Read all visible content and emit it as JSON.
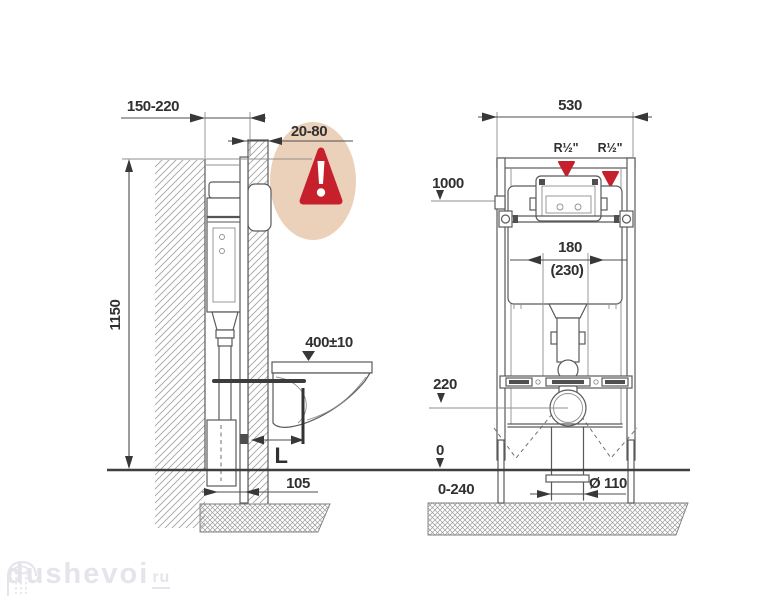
{
  "side_view": {
    "wall_depth": "150-220",
    "cladding_thickness": "20-80",
    "frame_height": "1150",
    "seat_height": "400±10",
    "offset_label": "L",
    "frame_depth": "105"
  },
  "front_view": {
    "frame_width": "530",
    "water_conn_left": "R½\"",
    "water_conn_right": "R½\"",
    "install_height": "1000",
    "flush_pipe_offset": "180",
    "flush_pipe_offset_alt": "(230)",
    "outlet_height": "220",
    "floor_level": "0",
    "below_floor_range": "0-240",
    "drain_diameter": "Ø 110"
  },
  "colors": {
    "line": "#5a5a5a",
    "text": "#303030",
    "accent_red": "#c5202b",
    "warning_bg": "#ecd1ba",
    "watermark": "#e4e4ea"
  },
  "watermark": {
    "name": "dushevoi",
    "tld": "ru"
  }
}
